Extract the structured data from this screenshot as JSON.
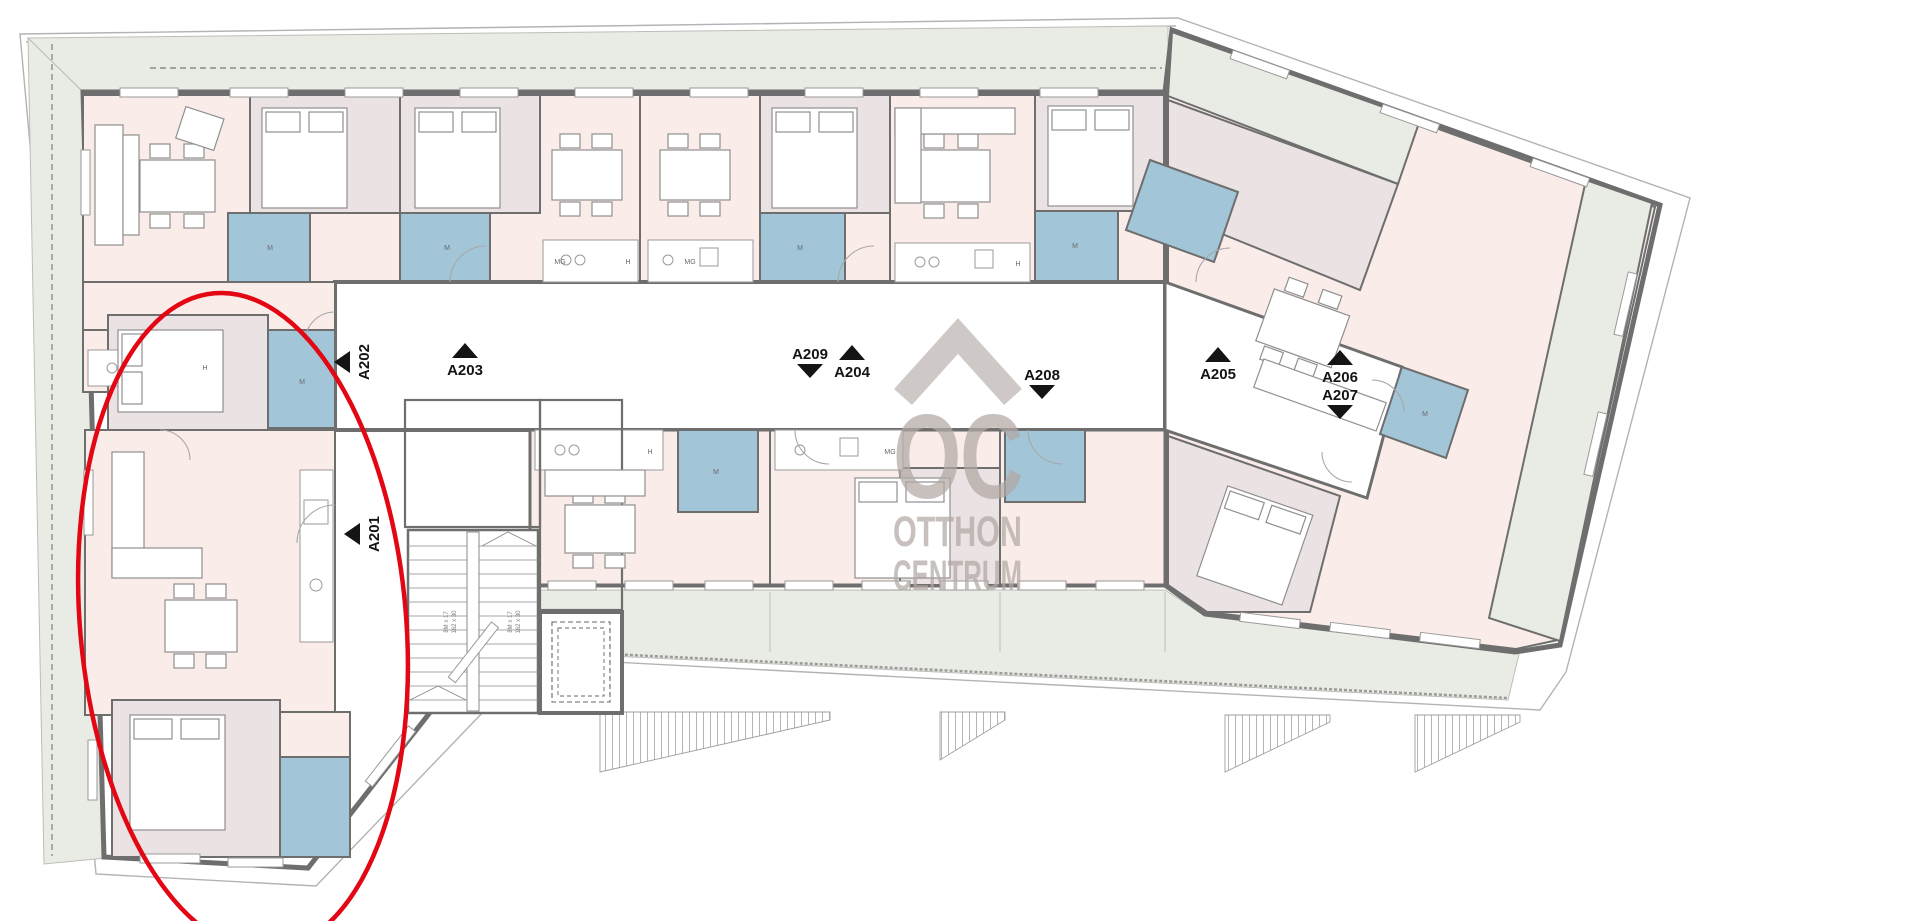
{
  "plan": {
    "type": "floor-plan",
    "floor": "2",
    "highlighted_unit": "A201"
  },
  "apartments": [
    {
      "id": "A201",
      "arrow": "left"
    },
    {
      "id": "A202",
      "arrow": "left"
    },
    {
      "id": "A203",
      "arrow": "up"
    },
    {
      "id": "A204",
      "arrow": "up"
    },
    {
      "id": "A205",
      "arrow": "up"
    },
    {
      "id": "A206",
      "arrow": "up"
    },
    {
      "id": "A207",
      "arrow": "down"
    },
    {
      "id": "A208",
      "arrow": "down"
    },
    {
      "id": "A209",
      "arrow": "down"
    }
  ],
  "watermark": {
    "monogram": "OC",
    "line1": "OTTHON",
    "line2": "CENTRUM"
  },
  "fixtures": {
    "washing_machine": "M",
    "fridge": "H",
    "dishwasher": "MG"
  },
  "stairs": {
    "flight_note_line1": "8M x 17",
    "flight_note_line2": "162 x 30"
  },
  "colors": {
    "wall": "#6e6e6e",
    "room_pink": "#f9ece9",
    "room_mauve": "#eae2e3",
    "bathroom_blue": "#a2c5d8",
    "terrace_green": "#e9ece4",
    "watermark_gray": "#b2a9a5",
    "highlight_red": "#e30613"
  }
}
